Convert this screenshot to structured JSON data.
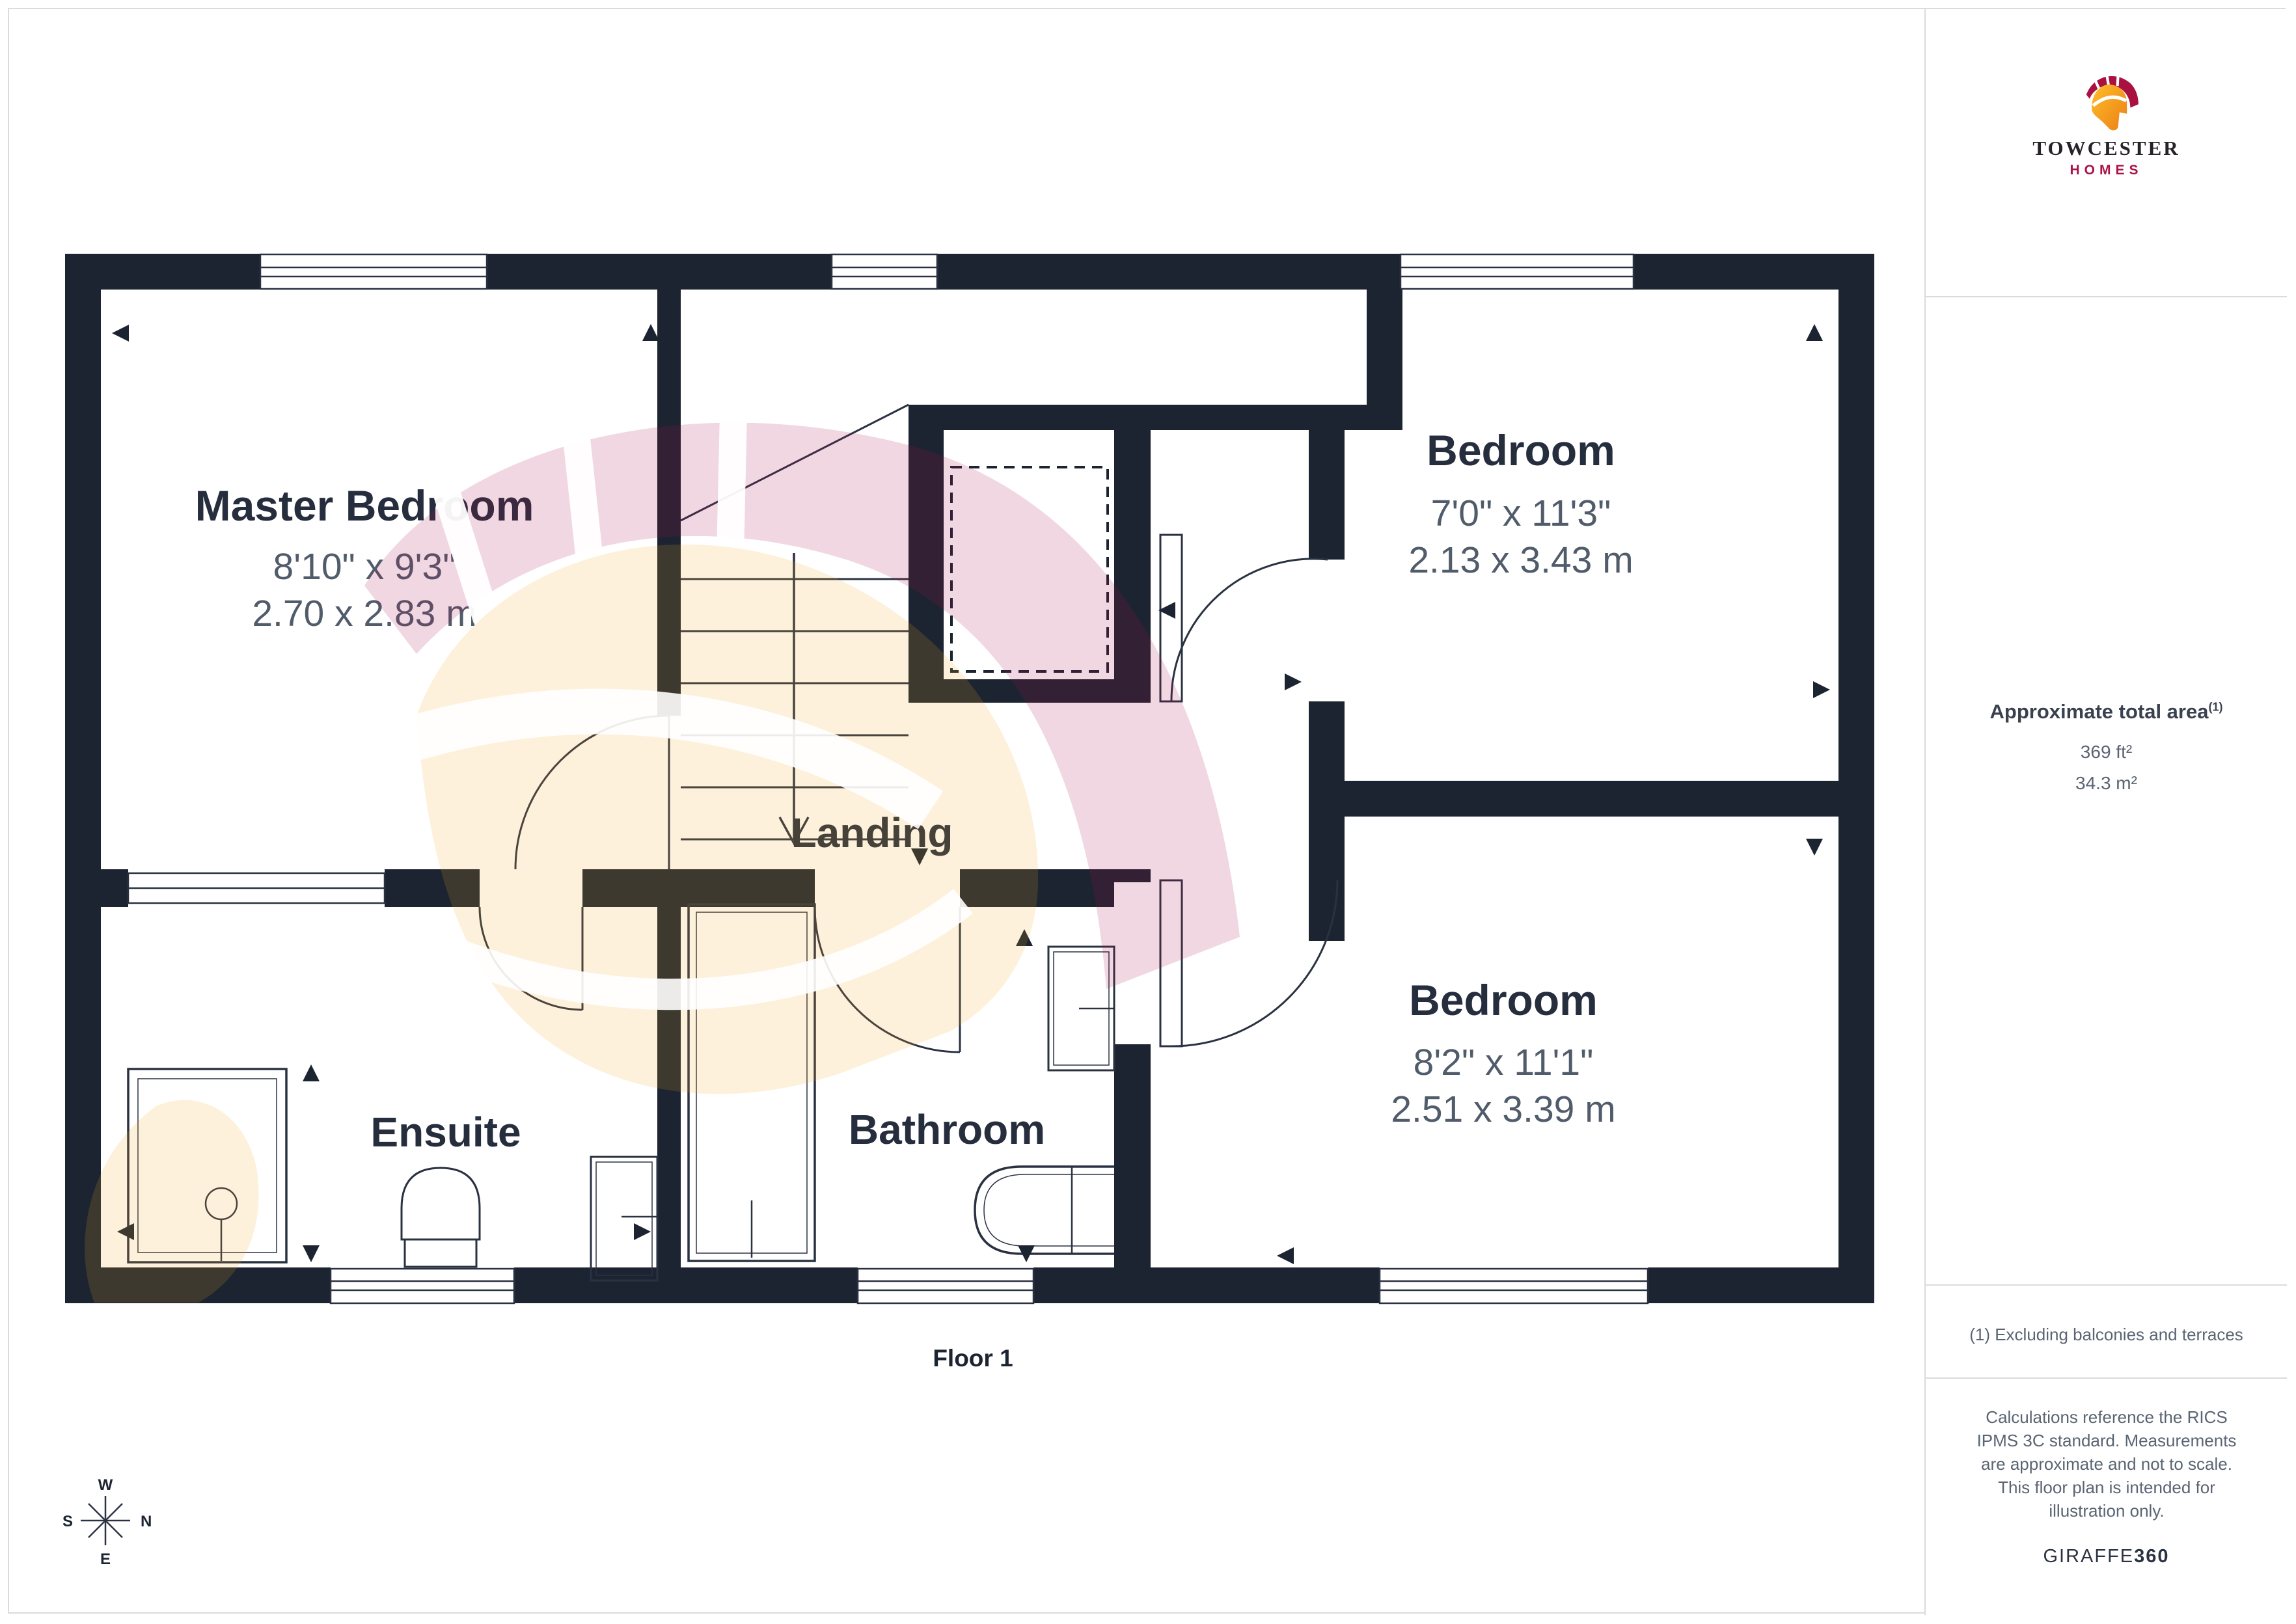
{
  "page": {
    "floor_label": "Floor 1"
  },
  "logo": {
    "title": "TOWCESTER",
    "subtitle": "HOMES"
  },
  "sidebar": {
    "area_title": "Approximate total area",
    "area_sup": "(1)",
    "area_ft": "369 ft²",
    "area_m": "34.3 m²",
    "footnote": "(1) Excluding balconies and terraces",
    "disclaimer": "Calculations reference the RICS IPMS 3C standard. Measurements are approximate and not to scale. This floor plan is intended for illustration only.",
    "brand": "GIRAFFE",
    "brand_bold": "360"
  },
  "rooms": {
    "master": {
      "name": "Master Bedroom",
      "imperial": "8'10\" x 9'3\"",
      "metric": "2.70 x 2.83 m"
    },
    "bedroom_top": {
      "name": "Bedroom",
      "imperial": "7'0\" x 11'3\"",
      "metric": "2.13 x 3.43 m"
    },
    "bedroom_bottom": {
      "name": "Bedroom",
      "imperial": "8'2\" x 11'1\"",
      "metric": "2.51 x 3.39 m"
    },
    "landing": {
      "name": "Landing"
    },
    "ensuite": {
      "name": "Ensuite"
    },
    "bathroom": {
      "name": "Bathroom"
    }
  },
  "compass": {
    "n": "N",
    "s": "S",
    "e": "E",
    "w": "W"
  },
  "colors": {
    "wall": "#1c2431",
    "line": "#2a3242",
    "label_dark": "#262e3e",
    "dims_slate": "#515c6b",
    "brand_crimson": "#a91349",
    "brand_orange": "#f6a21d",
    "watermark_pink": "rgba(168,18,75,0.17)",
    "watermark_yellow": "rgba(244,170,30,0.16)",
    "border_gray": "#d9dbdd"
  }
}
